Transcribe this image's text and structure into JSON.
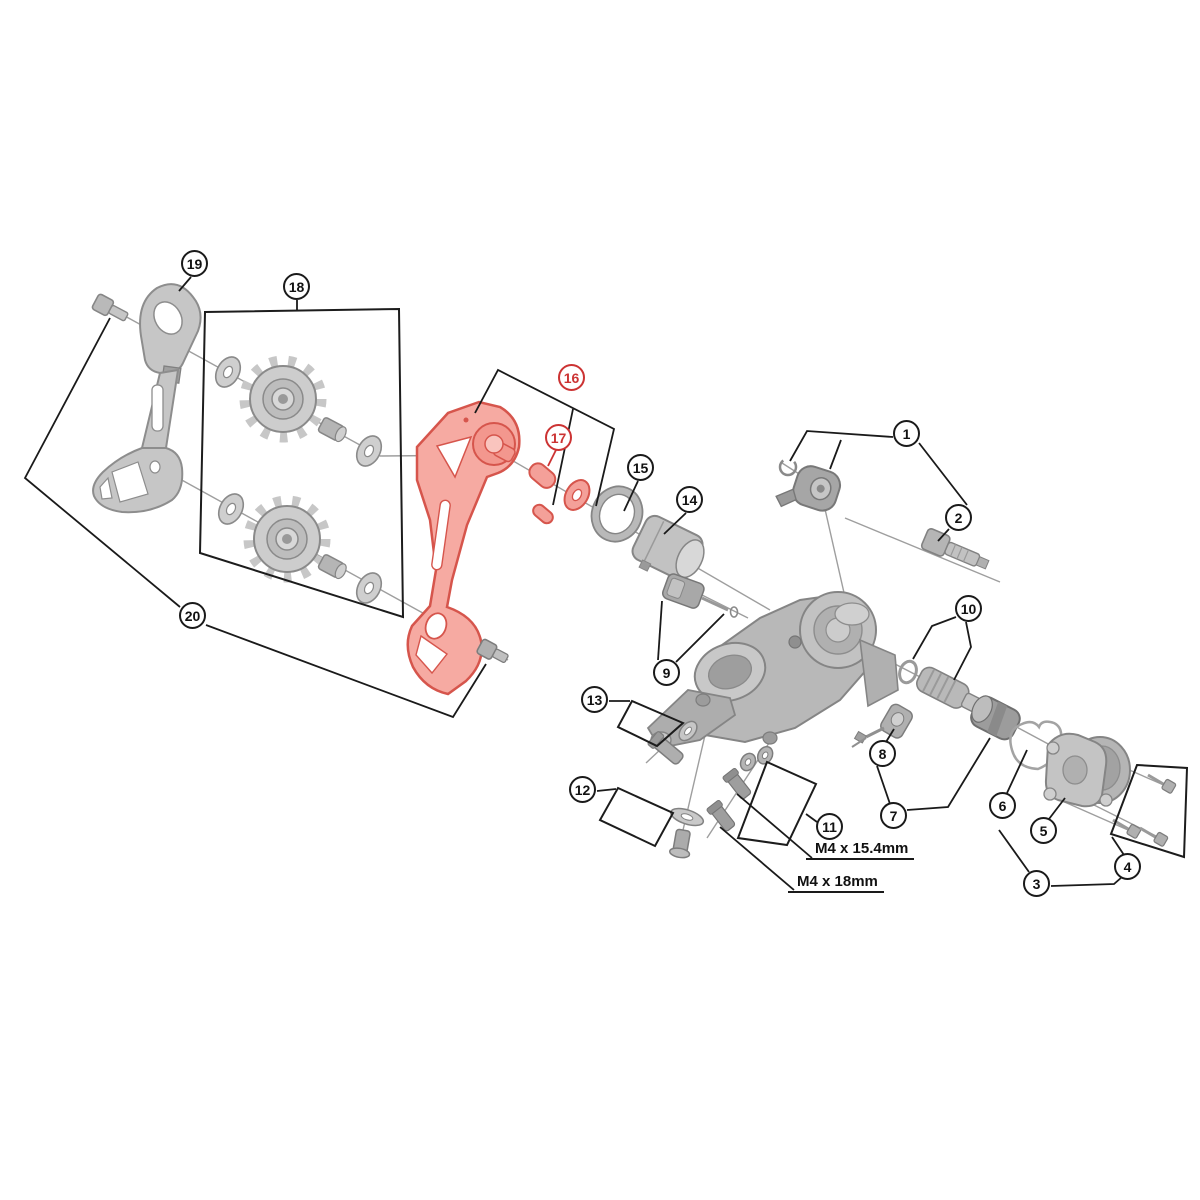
{
  "page": {
    "title": "Rear derailleur exploded parts diagram",
    "background": "#ffffff"
  },
  "callouts": [
    {
      "id": 1,
      "label": "1",
      "highlighted": false
    },
    {
      "id": 2,
      "label": "2",
      "highlighted": false
    },
    {
      "id": 3,
      "label": "3",
      "highlighted": false
    },
    {
      "id": 4,
      "label": "4",
      "highlighted": false
    },
    {
      "id": 5,
      "label": "5",
      "highlighted": false
    },
    {
      "id": 6,
      "label": "6",
      "highlighted": false
    },
    {
      "id": 7,
      "label": "7",
      "highlighted": false
    },
    {
      "id": 8,
      "label": "8",
      "highlighted": false
    },
    {
      "id": 9,
      "label": "9",
      "highlighted": false
    },
    {
      "id": 10,
      "label": "10",
      "highlighted": false
    },
    {
      "id": 11,
      "label": "11",
      "highlighted": false
    },
    {
      "id": 12,
      "label": "12",
      "highlighted": false
    },
    {
      "id": 13,
      "label": "13",
      "highlighted": false
    },
    {
      "id": 14,
      "label": "14",
      "highlighted": false
    },
    {
      "id": 15,
      "label": "15",
      "highlighted": false
    },
    {
      "id": 16,
      "label": "16",
      "highlighted": true
    },
    {
      "id": 17,
      "label": "17",
      "highlighted": true
    },
    {
      "id": 18,
      "label": "18",
      "highlighted": false
    },
    {
      "id": 19,
      "label": "19",
      "highlighted": false
    },
    {
      "id": 20,
      "label": "20",
      "highlighted": false
    }
  ],
  "labels": {
    "screw_spec_upper": "M4 x 15.4mm",
    "screw_spec_lower": "M4 x 18mm"
  },
  "colors": {
    "background": "#ffffff",
    "line": "#1a1a1a",
    "axis_line": "#9e9e9e",
    "part_fill": "#c6c6c6",
    "part_stroke": "#8a8a8a",
    "highlight_fill": "#f6aaa2",
    "highlight_stroke": "#d6554c",
    "callout_highlight": "#cc3333"
  }
}
